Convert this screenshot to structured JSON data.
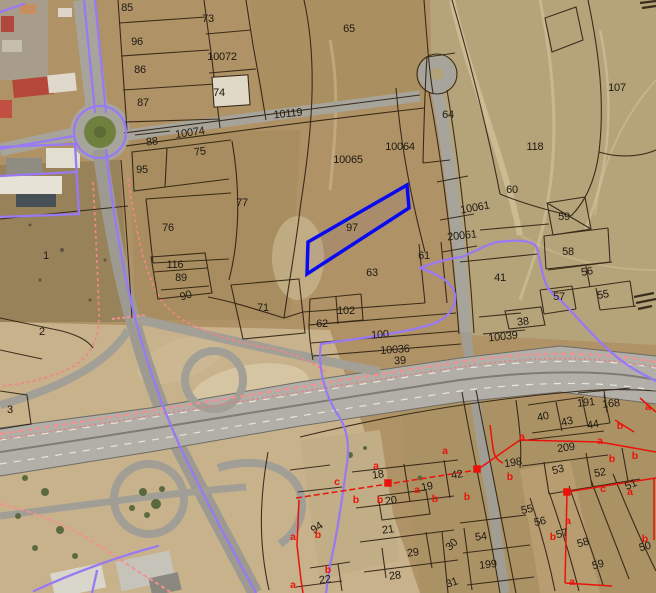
{
  "map": {
    "kind": "cadastral-parcel-overlay-on-aerial",
    "selected_parcel": "97",
    "colors": {
      "selected_parcel_outline": "#0a0af2",
      "parcel_boundary": "#2a1d0e",
      "admin_boundary_purple": "#997af2",
      "zone_overlay_red": "#ea130a",
      "railway_pink": "#f59090"
    },
    "parcel_labels": [
      {
        "text": "85",
        "x": 127,
        "y": 8
      },
      {
        "text": "73",
        "x": 208,
        "y": 19
      },
      {
        "text": "96",
        "x": 137,
        "y": 42
      },
      {
        "text": "10072",
        "x": 222,
        "y": 57
      },
      {
        "text": "65",
        "x": 349,
        "y": 29
      },
      {
        "text": "86",
        "x": 140,
        "y": 70
      },
      {
        "text": "74",
        "x": 219,
        "y": 93
      },
      {
        "text": "87",
        "x": 143,
        "y": 103
      },
      {
        "text": "10119",
        "x": 288,
        "y": 114,
        "r": -6
      },
      {
        "text": "64",
        "x": 448,
        "y": 115
      },
      {
        "text": "107",
        "x": 617,
        "y": 88
      },
      {
        "text": "118",
        "x": 535,
        "y": 147
      },
      {
        "text": "88",
        "x": 152,
        "y": 142,
        "r": -6
      },
      {
        "text": "10074",
        "x": 190,
        "y": 133,
        "r": -8
      },
      {
        "text": "75",
        "x": 200,
        "y": 152,
        "r": -8
      },
      {
        "text": "95",
        "x": 142,
        "y": 170
      },
      {
        "text": "10065",
        "x": 348,
        "y": 160
      },
      {
        "text": "10064",
        "x": 400,
        "y": 147
      },
      {
        "text": "77",
        "x": 242,
        "y": 203
      },
      {
        "text": "60",
        "x": 512,
        "y": 190
      },
      {
        "text": "10061",
        "x": 475,
        "y": 208,
        "r": -10
      },
      {
        "text": "97",
        "x": 352,
        "y": 228
      },
      {
        "text": "59",
        "x": 564,
        "y": 217
      },
      {
        "text": "20061",
        "x": 462,
        "y": 236,
        "r": -6
      },
      {
        "text": "76",
        "x": 168,
        "y": 228
      },
      {
        "text": "61",
        "x": 424,
        "y": 256
      },
      {
        "text": "58",
        "x": 568,
        "y": 252
      },
      {
        "text": "41",
        "x": 500,
        "y": 278
      },
      {
        "text": "63",
        "x": 372,
        "y": 273
      },
      {
        "text": "56",
        "x": 587,
        "y": 272,
        "r": -10
      },
      {
        "text": "116",
        "x": 175,
        "y": 265
      },
      {
        "text": "89",
        "x": 181,
        "y": 278
      },
      {
        "text": "55",
        "x": 603,
        "y": 295,
        "r": -10
      },
      {
        "text": "57",
        "x": 559,
        "y": 297
      },
      {
        "text": "90",
        "x": 186,
        "y": 296,
        "r": -18
      },
      {
        "text": "1",
        "x": 46,
        "y": 256
      },
      {
        "text": "71",
        "x": 263,
        "y": 308
      },
      {
        "text": "38",
        "x": 523,
        "y": 322,
        "r": -6
      },
      {
        "text": "62",
        "x": 322,
        "y": 324
      },
      {
        "text": "102",
        "x": 346,
        "y": 311
      },
      {
        "text": "100",
        "x": 380,
        "y": 335,
        "r": -4
      },
      {
        "text": "10039",
        "x": 503,
        "y": 337,
        "r": -6
      },
      {
        "text": "2",
        "x": 42,
        "y": 332
      },
      {
        "text": "10036",
        "x": 395,
        "y": 350,
        "r": -4
      },
      {
        "text": "39",
        "x": 400,
        "y": 361,
        "r": -4
      },
      {
        "text": "3",
        "x": 10,
        "y": 410
      },
      {
        "text": "40",
        "x": 543,
        "y": 417,
        "r": -12
      },
      {
        "text": "43",
        "x": 567,
        "y": 422,
        "r": -14
      },
      {
        "text": "44",
        "x": 593,
        "y": 425,
        "r": -10
      },
      {
        "text": "191",
        "x": 586,
        "y": 403,
        "r": -6
      },
      {
        "text": "168",
        "x": 611,
        "y": 404,
        "r": -6
      },
      {
        "text": "209",
        "x": 566,
        "y": 448,
        "r": -8
      },
      {
        "text": "198",
        "x": 513,
        "y": 463,
        "r": -8
      },
      {
        "text": "53",
        "x": 558,
        "y": 470,
        "r": -14
      },
      {
        "text": "52",
        "x": 600,
        "y": 473,
        "r": -10
      },
      {
        "text": "51",
        "x": 631,
        "y": 485,
        "r": -24
      },
      {
        "text": "42",
        "x": 457,
        "y": 475,
        "r": -10
      },
      {
        "text": "19",
        "x": 427,
        "y": 487,
        "r": -10
      },
      {
        "text": "18",
        "x": 378,
        "y": 475,
        "r": -8
      },
      {
        "text": "20",
        "x": 391,
        "y": 501,
        "r": -8
      },
      {
        "text": "94",
        "x": 317,
        "y": 528,
        "r": -35
      },
      {
        "text": "21",
        "x": 388,
        "y": 530,
        "r": -8
      },
      {
        "text": "54",
        "x": 481,
        "y": 537,
        "r": -8
      },
      {
        "text": "30",
        "x": 452,
        "y": 545,
        "r": -45
      },
      {
        "text": "29",
        "x": 413,
        "y": 553,
        "r": -8
      },
      {
        "text": "55",
        "x": 527,
        "y": 510,
        "r": -12
      },
      {
        "text": "56",
        "x": 540,
        "y": 522,
        "r": -12
      },
      {
        "text": "57",
        "x": 562,
        "y": 534,
        "r": -14
      },
      {
        "text": "58",
        "x": 583,
        "y": 543,
        "r": -14
      },
      {
        "text": "59",
        "x": 598,
        "y": 565,
        "r": -14
      },
      {
        "text": "50",
        "x": 645,
        "y": 547,
        "r": -14
      },
      {
        "text": "199",
        "x": 488,
        "y": 565,
        "r": -6
      },
      {
        "text": "28",
        "x": 395,
        "y": 576,
        "r": -8
      },
      {
        "text": "22",
        "x": 325,
        "y": 580,
        "r": -8
      },
      {
        "text": "31",
        "x": 452,
        "y": 583,
        "r": -20
      }
    ],
    "red_zone_labels": [
      {
        "text": "a",
        "x": 376,
        "y": 466
      },
      {
        "text": "c",
        "x": 337,
        "y": 482
      },
      {
        "text": "b",
        "x": 356,
        "y": 500
      },
      {
        "text": "b",
        "x": 380,
        "y": 500
      },
      {
        "text": "a",
        "x": 417,
        "y": 490
      },
      {
        "text": "b",
        "x": 435,
        "y": 499
      },
      {
        "text": "b",
        "x": 467,
        "y": 497
      },
      {
        "text": "a",
        "x": 445,
        "y": 451
      },
      {
        "text": "a",
        "x": 293,
        "y": 537
      },
      {
        "text": "b",
        "x": 318,
        "y": 535
      },
      {
        "text": "b",
        "x": 328,
        "y": 570
      },
      {
        "text": "a",
        "x": 293,
        "y": 585
      },
      {
        "text": "a",
        "x": 522,
        "y": 437
      },
      {
        "text": "b",
        "x": 510,
        "y": 477
      },
      {
        "text": "a",
        "x": 600,
        "y": 441
      },
      {
        "text": "b",
        "x": 620,
        "y": 426
      },
      {
        "text": "b",
        "x": 612,
        "y": 459
      },
      {
        "text": "b",
        "x": 635,
        "y": 456
      },
      {
        "text": "c",
        "x": 603,
        "y": 489
      },
      {
        "text": "a",
        "x": 630,
        "y": 492
      },
      {
        "text": "a",
        "x": 568,
        "y": 521
      },
      {
        "text": "b",
        "x": 553,
        "y": 537
      },
      {
        "text": "b",
        "x": 645,
        "y": 539
      },
      {
        "text": "a",
        "x": 572,
        "y": 582
      },
      {
        "text": "a",
        "x": 648,
        "y": 407
      }
    ]
  }
}
